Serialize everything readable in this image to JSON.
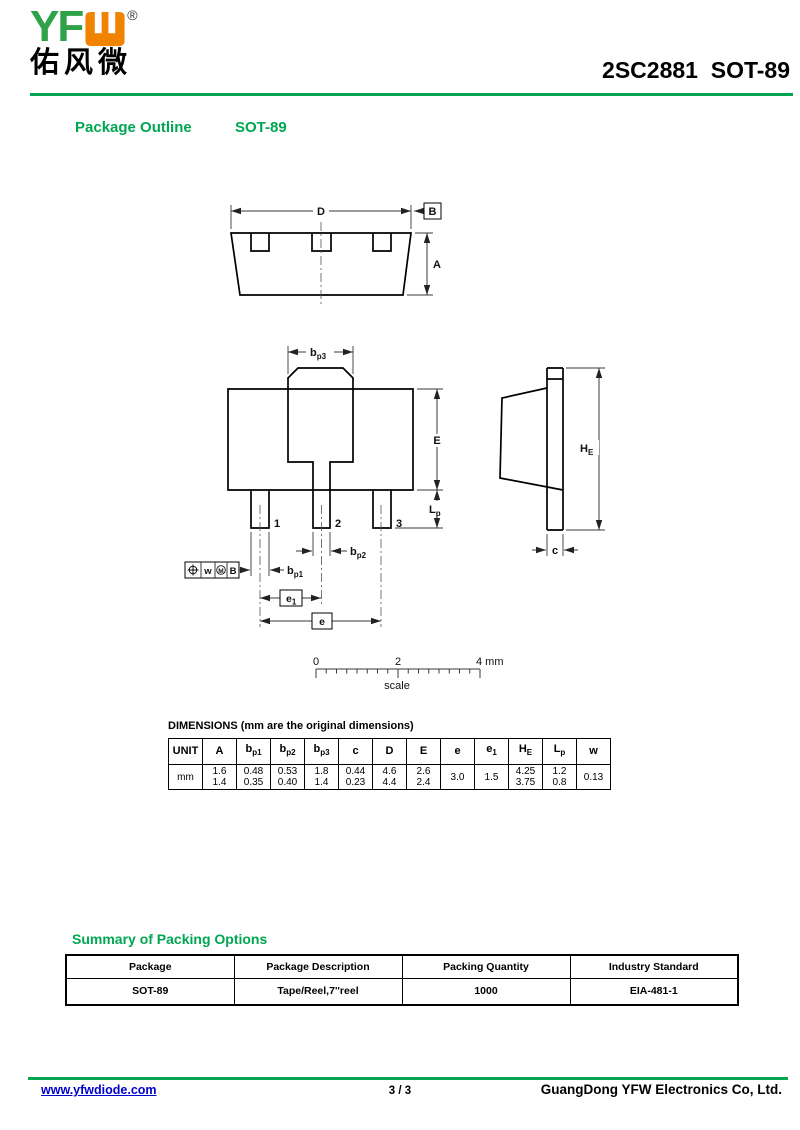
{
  "colors": {
    "accent_green": "#00A651",
    "logo_green": "#2EA149",
    "logo_orange": "#F08300",
    "link_blue": "#0000CC"
  },
  "header": {
    "logo_text": "YF",
    "logo_registered": "®",
    "logo_chinese": "佑风微",
    "part_title": "2SC2881  SOT-89"
  },
  "section": {
    "outline_label": "Package Outline",
    "package_name": "SOT-89"
  },
  "drawing": {
    "labels": {
      "D": "D",
      "B": "B",
      "A": "A",
      "bp3_main": "b",
      "bp3_sub": "p3",
      "E": "E",
      "Lp_main": "L",
      "Lp_sub": "p",
      "pin1": "1",
      "pin2": "2",
      "pin3": "3",
      "bp2_main": "b",
      "bp2_sub": "p2",
      "bp1_main": "b",
      "bp1_sub": "p1",
      "fcf_w": "w",
      "fcf_m": "M",
      "fcf_b": "B",
      "e1_main": "e",
      "e1_sub": "1",
      "e": "e",
      "HE_main": "H",
      "HE_sub": "E",
      "c": "c",
      "scale_0": "0",
      "scale_2": "2",
      "scale_4": "4 mm",
      "scale_caption": "scale"
    }
  },
  "dimensions_table": {
    "title": "DIMENSIONS (mm are the original dimensions)",
    "unit": "mm",
    "columns": [
      {
        "main": "UNIT",
        "sub": ""
      },
      {
        "main": "A",
        "sub": ""
      },
      {
        "main": "b",
        "sub": "p1"
      },
      {
        "main": "b",
        "sub": "p2"
      },
      {
        "main": "b",
        "sub": "p3"
      },
      {
        "main": "c",
        "sub": ""
      },
      {
        "main": "D",
        "sub": ""
      },
      {
        "main": "E",
        "sub": ""
      },
      {
        "main": "e",
        "sub": ""
      },
      {
        "main": "e",
        "sub": "1"
      },
      {
        "main": "H",
        "sub": "E"
      },
      {
        "main": "L",
        "sub": "p"
      },
      {
        "main": "w",
        "sub": ""
      }
    ],
    "values": [
      [
        "1.6",
        "1.4"
      ],
      [
        "0.48",
        "0.35"
      ],
      [
        "0.53",
        "0.40"
      ],
      [
        "1.8",
        "1.4"
      ],
      [
        "0.44",
        "0.23"
      ],
      [
        "4.6",
        "4.4"
      ],
      [
        "2.6",
        "2.4"
      ],
      [
        "3.0"
      ],
      [
        "1.5"
      ],
      [
        "4.25",
        "3.75"
      ],
      [
        "1.2",
        "0.8"
      ],
      [
        "0.13"
      ]
    ]
  },
  "packing": {
    "heading": "Summary of Packing Options",
    "columns": [
      "Package",
      "Package Description",
      "Packing Quantity",
      "Industry Standard"
    ],
    "rows": [
      [
        "SOT-89",
        "Tape/Reel,7''reel",
        "1000",
        "EIA-481-1"
      ]
    ]
  },
  "footer": {
    "website": "www.yfwdiode.com",
    "page": "3 / 3",
    "company": "GuangDong YFW Electronics Co, Ltd."
  }
}
